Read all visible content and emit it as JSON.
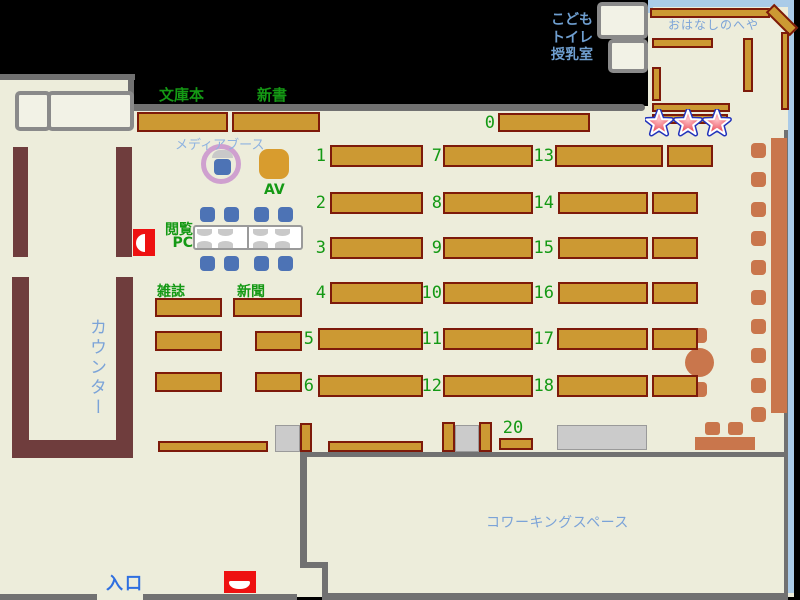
{
  "title": "library-floor-map",
  "colors": {
    "bg_cream": "#ededdb",
    "wall_gray": "#717171",
    "shelf_fill": "#cc9933",
    "shelf_border": "#7d1a0a",
    "counter_maroon": "#6f3d3d",
    "furniture_orange": "#c9764c",
    "chair_blue": "#4d73b5",
    "gray_furniture": "#cbcbcb",
    "box_cream": "#f2f2e6",
    "box_border_gray": "#8a8a8a",
    "room_border_blue": "#aacbe8",
    "red": "#ee1111",
    "plum": "#cfa0cf",
    "av_orange": "#d89c2e",
    "green_text": "#149914",
    "blue_text": "#7ba3d8",
    "kids_text_blue": "#6f9fd0",
    "entrance_blue": "#2f6fe0",
    "media_text_blue": "#8fb3e0",
    "star_red": "#e63a48",
    "star_blue": "#2233bb"
  },
  "map": {
    "ceiling_labels": {
      "bunkobon": "文庫本",
      "shinsho": "新書",
      "kodomo": "こども",
      "toire": "トイレ",
      "junyushitsu": "授乳室"
    },
    "rooms": {
      "ohanashi": "おはなしのへや",
      "coworking": "コワーキングスペース"
    },
    "labels": {
      "media_booth": "メディアブース",
      "av": "AV",
      "pc_line1": "閲覧",
      "pc_line2": "PC",
      "zasshi": "雑誌",
      "shinbun": "新聞",
      "counter": "カウンター",
      "entrance": "入口"
    },
    "shelf_numbers": {
      "zero": "0",
      "twenty": "20",
      "grid": [
        [
          "1",
          "7",
          "13"
        ],
        [
          "2",
          "8",
          "14"
        ],
        [
          "3",
          "9",
          "15"
        ],
        [
          "4",
          "10",
          "16"
        ],
        [
          "5",
          "11",
          "17"
        ],
        [
          "6",
          "12",
          "18"
        ]
      ]
    }
  }
}
